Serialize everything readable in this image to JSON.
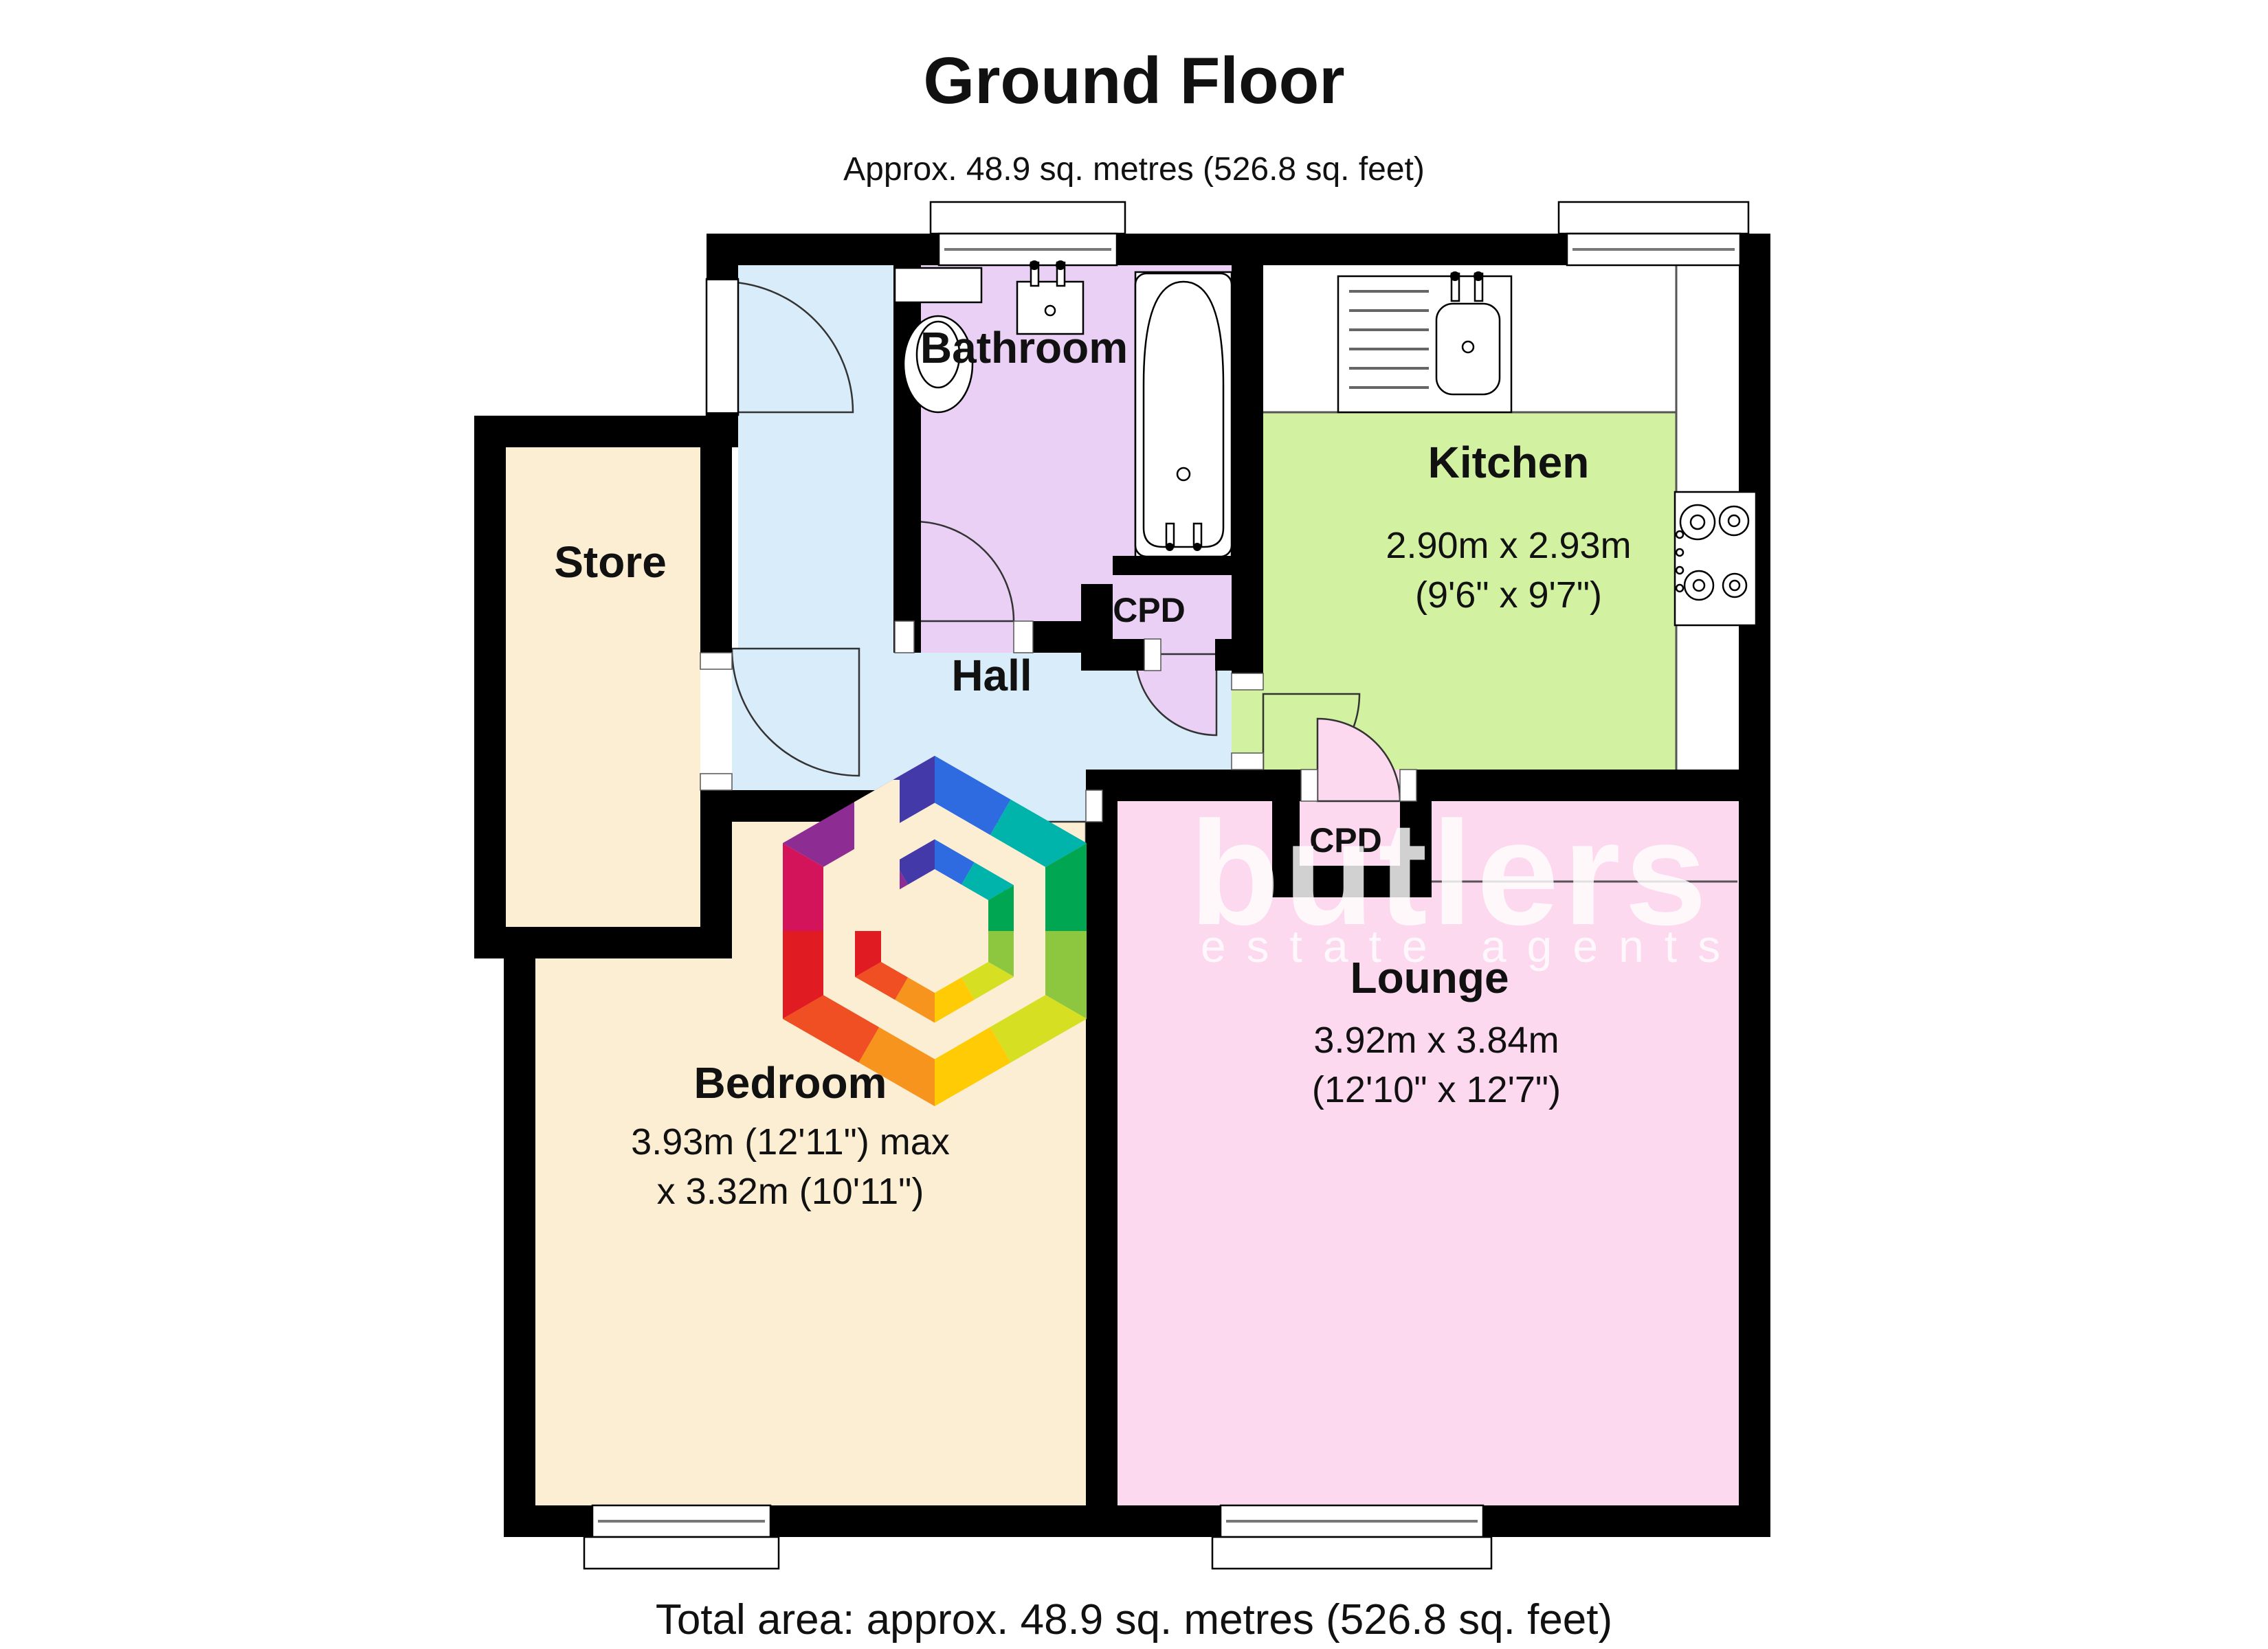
{
  "header": {
    "title": "Ground Floor",
    "subtitle": "Approx. 48.9 sq. metres (526.8 sq. feet)"
  },
  "footer": {
    "total_area": "Total area: approx. 48.9 sq. metres (526.8 sq. feet)"
  },
  "watermark": {
    "brand": "butlers",
    "tagline": "estate agents"
  },
  "rooms": {
    "bathroom": {
      "label": "Bathroom"
    },
    "kitchen": {
      "label": "Kitchen",
      "dimensions_metric": "2.90m x 2.93m",
      "dimensions_imperial": "(9'6\" x 9'7\")"
    },
    "store": {
      "label": "Store"
    },
    "hall": {
      "label": "Hall"
    },
    "cupboard_top": {
      "label": "CPD"
    },
    "cupboard_lounge": {
      "label": "CPD"
    },
    "lounge": {
      "label": "Lounge",
      "dimensions_metric": "3.92m x 3.84m",
      "dimensions_imperial": "(12'10\" x 12'7\")"
    },
    "bedroom": {
      "label": "Bedroom",
      "dimensions_line1": "3.93m (12'11\") max",
      "dimensions_line2": "x 3.32m (10'11\")"
    }
  },
  "colors": {
    "hall": "#d9ecfa",
    "bathroom": "#ead0f5",
    "kitchen": "#d2f1a1",
    "cream": "#fbeed3",
    "lounge": "#fcd9ee",
    "wall": "#000000",
    "watermark_text": "#ffffff"
  },
  "logo": {
    "wedges": [
      "#2e6be0",
      "#00b3ab",
      "#00a651",
      "#8dc63f",
      "#d7df23",
      "#ffcb05",
      "#f7941d",
      "#f04e23",
      "#e11b22",
      "#d4145a",
      "#8d2c92",
      "#4339a8"
    ]
  }
}
